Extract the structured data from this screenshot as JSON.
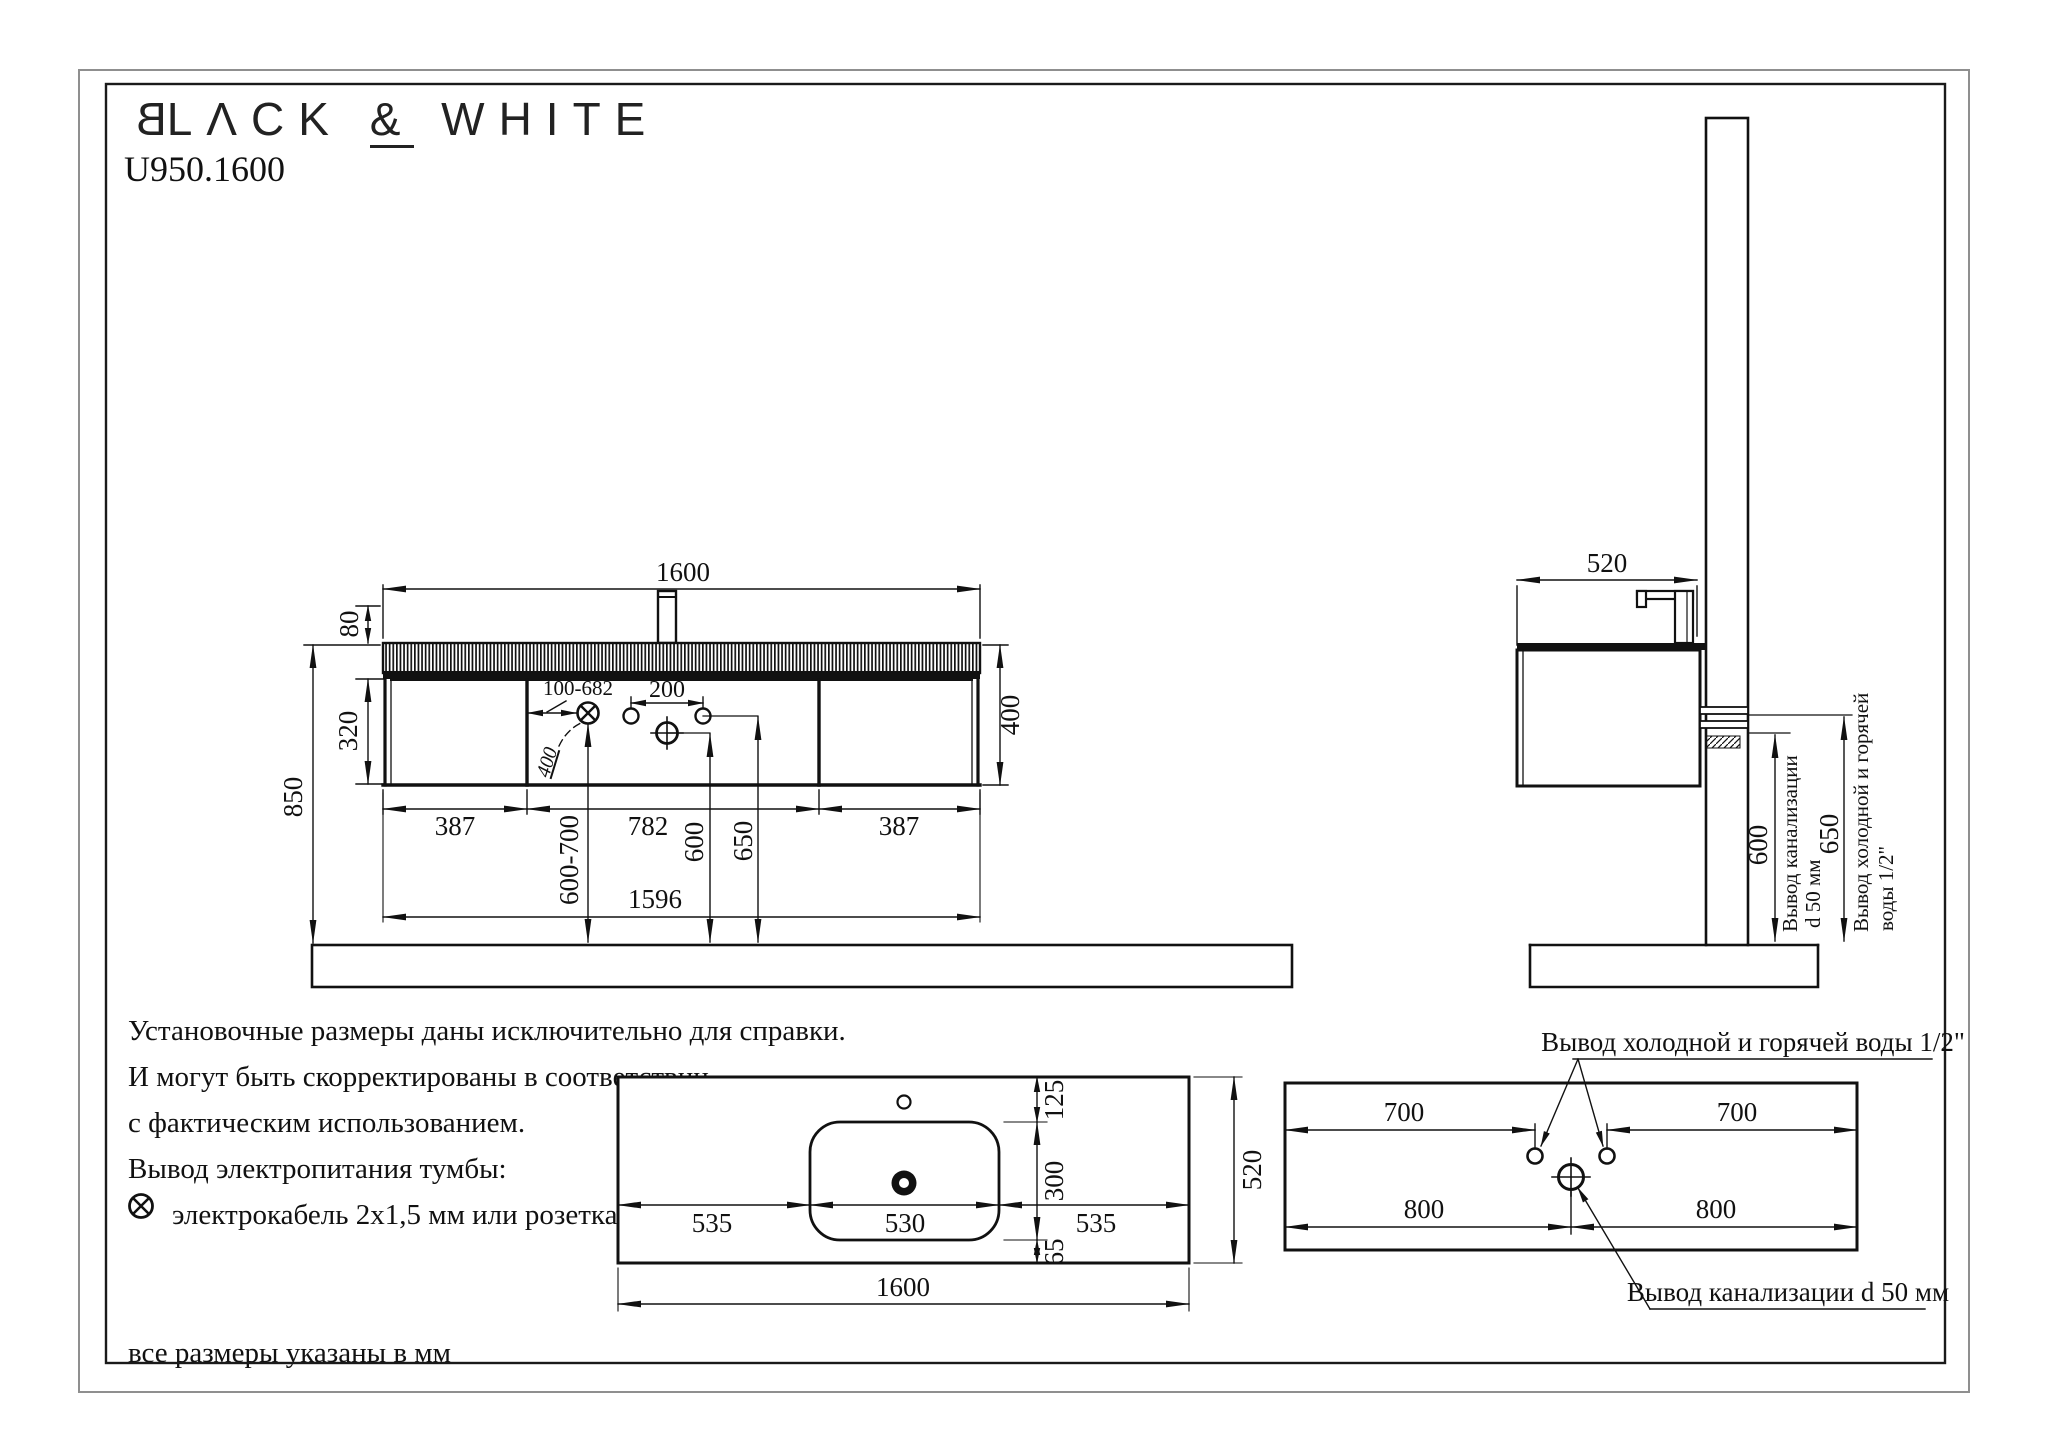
{
  "header": {
    "logo_b": "B",
    "logo_mid": "LΛCK",
    "logo_amp": "&",
    "logo_end": "WHITE",
    "model": "U950.1600"
  },
  "front": {
    "width_top": "1600",
    "tap_height": "80",
    "door_height": "320",
    "total_height": "850",
    "cabinet_height": "400",
    "width_left": "387",
    "width_center": "782",
    "width_right": "387",
    "width_mount": "1596",
    "socket_range": "100-682",
    "tap_holes": "200",
    "socket_depth": "400",
    "socket_height": "600-700",
    "drain_height": "600",
    "water_height": "650"
  },
  "side": {
    "depth": "520",
    "drain_height": "600",
    "water_height": "650",
    "drain_label_1": "Вывод канализации",
    "drain_label_2": "d 50 мм",
    "water_label_1": "Вывод холодной и горячей",
    "water_label_2": "воды 1/2\""
  },
  "top_view": {
    "width": "1600",
    "depth": "520",
    "tap_offset": "125",
    "bowl_depth": "300",
    "front_offset": "65",
    "left_margin": "535",
    "bowl_width": "530",
    "right_margin": "535"
  },
  "wall_view": {
    "water_left": "700",
    "water_right": "700",
    "drain_left": "800",
    "drain_right": "800",
    "water_label": "Вывод холодной и горячей воды 1/2\"",
    "drain_label": "Вывод канализации d 50 мм"
  },
  "notes": {
    "line1": "Установочные размеры даны исключительно для справки.",
    "line2": "И могут быть скорректированы в соответствии",
    "line3": "с фактическим использованием.",
    "line4": "Вывод электропитания тумбы:",
    "line5": "электрокабель 2x1,5 мм или розетка IP44.",
    "footer": "все размеры указаны в мм"
  }
}
